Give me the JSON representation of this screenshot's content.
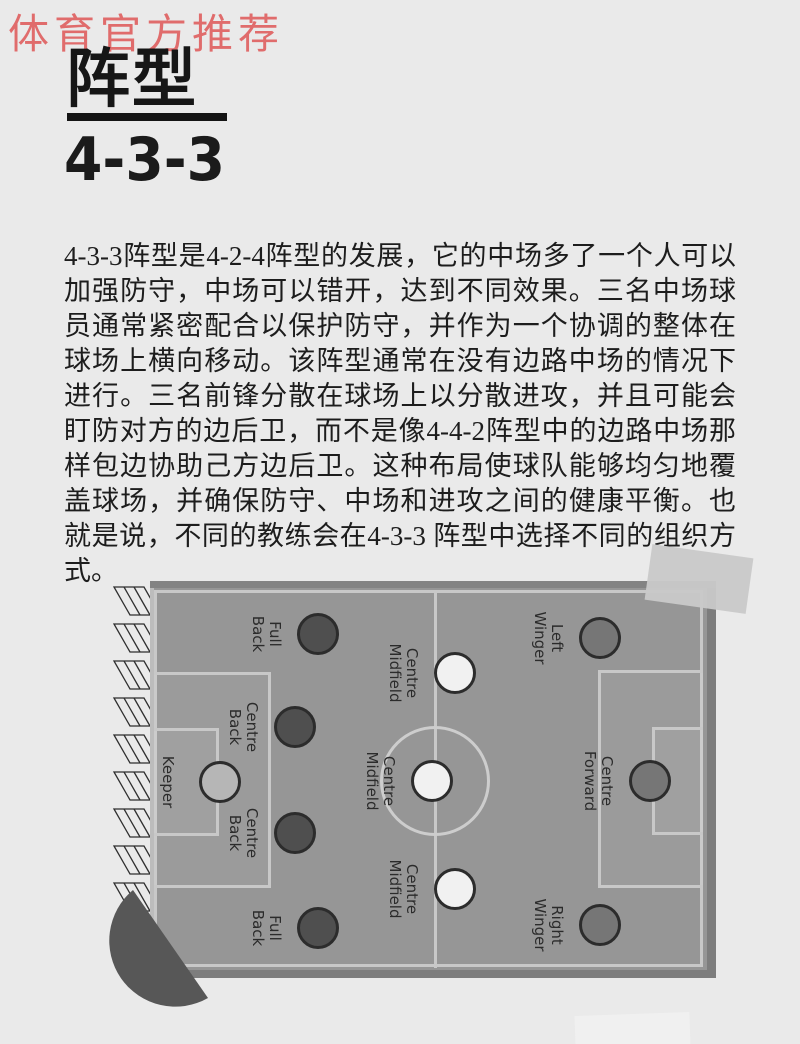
{
  "page": {
    "background_color": "#eaeaea",
    "accent_red": "#e06c6c"
  },
  "header": {
    "badge_text": "体育官方推荐"
  },
  "title": {
    "main": "阵型",
    "formation": "4-3-3"
  },
  "article": {
    "body": "4-3-3阵型是4-2-4阵型的发展，它的中场多了一个人可以加强防守，中场可以错开，达到不同效果。三名中场球员通常紧密配合以保护防守，并作为一个协调的整体在球场上横向移动。该阵型通常在没有边路中场的情况下进行。三名前锋分散在球场上以分散进攻，并且可能会盯防对方的边后卫，而不是像4-4-2阵型中的边路中场那样包边协助己方边后卫。这种布局使球队能够均匀地覆盖球场，并确保防守、中场和进攻之间的健康平衡。也就是说，不同的教练会在4-3-3 阵型中选择不同的组织方式。"
  },
  "diagram": {
    "formation": "4-3-3",
    "pitch_color": "#969696",
    "line_color": "#c8c8c8",
    "defender_color": "#4f4f4f",
    "midfielder_color": "#f1f1f1",
    "attacker_color": "#767676",
    "keeper_color": "#b6b6b6",
    "players": [
      {
        "label": "Full Back",
        "role": "defender"
      },
      {
        "label": "Centre Back",
        "role": "defender"
      },
      {
        "label": "Keeper",
        "role": "goalkeeper"
      },
      {
        "label": "Centre Back",
        "role": "defender"
      },
      {
        "label": "Full Back",
        "role": "defender"
      },
      {
        "label": "Centre Midfield",
        "role": "midfielder"
      },
      {
        "label": "Centre Midfield",
        "role": "midfielder"
      },
      {
        "label": "Centre Midfield",
        "role": "midfielder"
      },
      {
        "label": "Left Winger",
        "role": "attacker"
      },
      {
        "label": "Centre Forward",
        "role": "attacker"
      },
      {
        "label": "Right Winger",
        "role": "attacker"
      }
    ]
  }
}
